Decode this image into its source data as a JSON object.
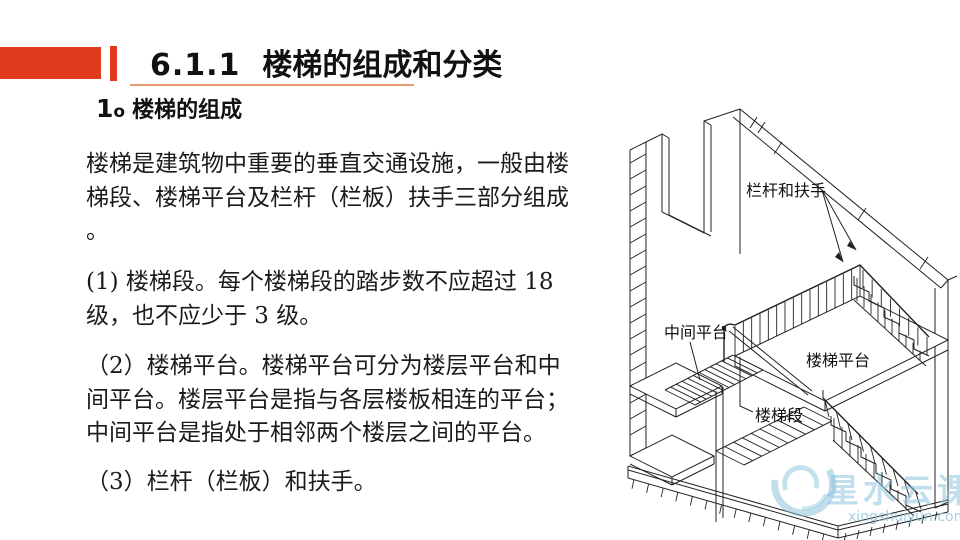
{
  "header": {
    "number": "6.1.1",
    "title": "楼梯的组成和分类"
  },
  "body": {
    "heading": {
      "num": "1",
      "ord": "o",
      "label": "楼梯的组成"
    },
    "p1": [
      "楼梯是建筑物中重要的垂直交通设施，一般由楼",
      "梯段、楼梯平台及栏杆（栏板）扶手三部分组成",
      "。"
    ],
    "p2": [
      "(1) 楼梯段。每个楼梯段的踏步数不应超过 18",
      "级，也不应少于 3 级。"
    ],
    "p3": [
      "（2）楼梯平台。楼梯平台可分为楼层平台和中",
      "间平台。楼层平台是指与各层楼板相连的平台；",
      "中间平台是指处于相邻两个楼层之间的平台。"
    ],
    "p4": [
      "（3）栏杆（栏板）和扶手。"
    ]
  },
  "diagram": {
    "labels": {
      "railing": "栏杆和扶手",
      "mid_platform": "中间平台",
      "floor_platform": "楼梯平台",
      "flight": "楼梯段"
    }
  },
  "watermark": {
    "brand": "星水云课",
    "domain": "xingshuiyun.com"
  },
  "colors": {
    "accent_red": "#DF3A1B",
    "underline_orange": "#E89A6E",
    "watermark_blue": "#8CC3DC",
    "line_color": "#222222"
  }
}
